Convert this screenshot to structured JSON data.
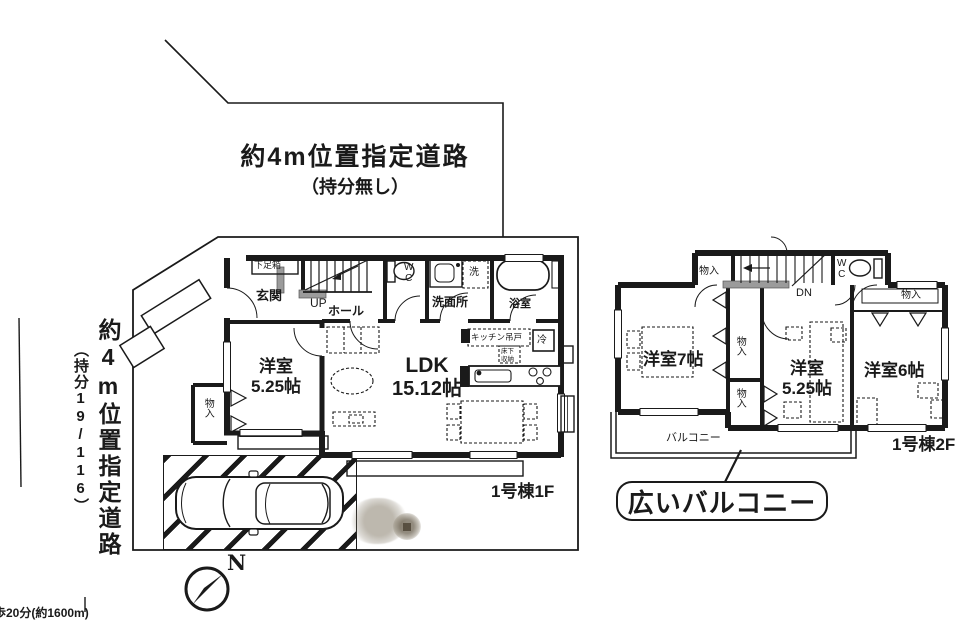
{
  "colors": {
    "ink": "#1a1a1a",
    "paper": "#ffffff",
    "stamp": "#8a8070"
  },
  "roads": {
    "top_road": {
      "line1": "約4m位置指定道路",
      "line2": "（持分無し）"
    },
    "left_road": {
      "line1": "約4m位置指定道路",
      "line2": "（持分19/116）"
    },
    "bottom_note": "歩20分(約1600m)"
  },
  "compass": {
    "label": "N"
  },
  "floor1": {
    "caption": "1号棟1F",
    "labels": {
      "shoe_box": "下足箱",
      "entrance": "玄関",
      "stairs_up": "UP",
      "hall": "ホール",
      "wc": "WC",
      "washer": "洗",
      "washroom": "洗面所",
      "bathroom": "浴室",
      "kitchen_cabinet": "キッチン吊戸",
      "fridge": "冷",
      "floor_storage": "床下収納",
      "ldk_name": "LDK",
      "ldk_size": "15.12帖",
      "bedroom_name": "洋室",
      "bedroom_size": "5.25帖",
      "closet": "物入"
    }
  },
  "floor2": {
    "caption": "1号棟2F",
    "labels": {
      "closet": "物入",
      "stairs_down": "DN",
      "wc": "WC",
      "bedroom7": "洋室7帖",
      "bedroom525_name": "洋室",
      "bedroom525_size": "5.25帖",
      "bedroom6": "洋室6帖",
      "balcony": "バルコニー"
    },
    "callout": "広いバルコニー"
  }
}
